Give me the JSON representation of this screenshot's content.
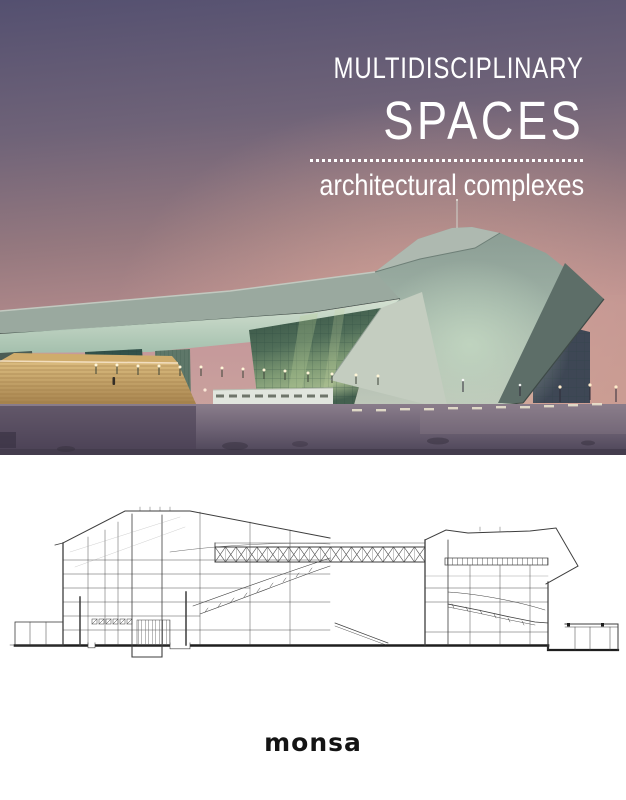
{
  "cover": {
    "title_line1": "MULTIDISCIPLINARY",
    "title_line2": "SPACES",
    "subtitle": "architectural complexes",
    "publisher": "monsa"
  },
  "artwork": {
    "photo_alt": "Dusk photograph of an angular modern performing-arts complex with cantilevered roof, glass walls, wide timber steps and an empty plaza",
    "drawing_alt": "Black-and-white longitudinal architectural section drawing of the complex"
  },
  "colors": {
    "title_text": "#ffffff",
    "publisher_text": "#141414",
    "sky_top": "#545070",
    "sky_horizon": "#c89a90",
    "building_face": "#9fb2a6",
    "glass_wall": "#4f6d58",
    "steps": "#c2a069",
    "plaza": "#564c60",
    "drawing_line": "#3d3d3d"
  }
}
